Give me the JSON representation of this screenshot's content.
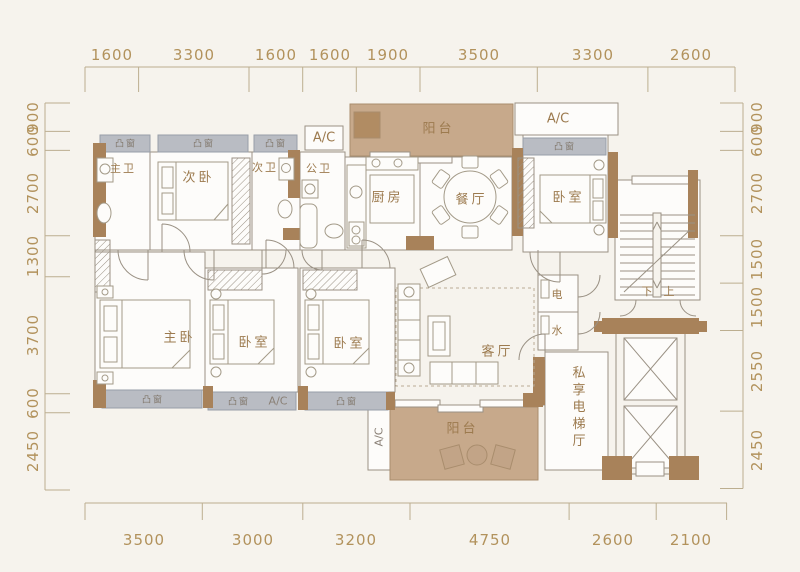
{
  "dimensions": {
    "top": [
      "1600",
      "3300",
      "1600",
      "1600",
      "1900",
      "3500",
      "3300",
      "2600"
    ],
    "bottom": [
      "3500",
      "3000",
      "3200",
      "4750",
      "2600",
      "2100"
    ],
    "left": [
      "900",
      "600",
      "2700",
      "1300",
      "3700",
      "600",
      "2450"
    ],
    "right": [
      "900",
      "600",
      "2700",
      "1500",
      "1500",
      "2550",
      "2450"
    ]
  },
  "rooms": {
    "master_bath": "主卫",
    "secondary_bedroom": "次卧",
    "secondary_bath": "次卫",
    "public_bath": "公卫",
    "kitchen": "厨房",
    "dining_room": "餐厅",
    "balcony_top": "阳台",
    "bedroom_right": "卧室",
    "master_bedroom": "主卧",
    "bedroom_2": "卧室",
    "bedroom_3": "卧室",
    "living_room": "客厅",
    "electric_shaft": "电",
    "water_shaft": "水",
    "stairs_down": "下",
    "stairs_up": "上",
    "private_elevator_hall": "私享电梯厅",
    "balcony_bottom": "阳台"
  },
  "labels": {
    "bay_window": "凸窗",
    "ac_unit": "A/C"
  },
  "colors": {
    "wall": "#a8825a",
    "bay_window": "#b9bcc3",
    "balcony": "#c7a98b",
    "outline": "#9a9184",
    "room_text": "#9c7a4e",
    "dim_text": "#b2925c",
    "background": "#f6f3ed"
  }
}
